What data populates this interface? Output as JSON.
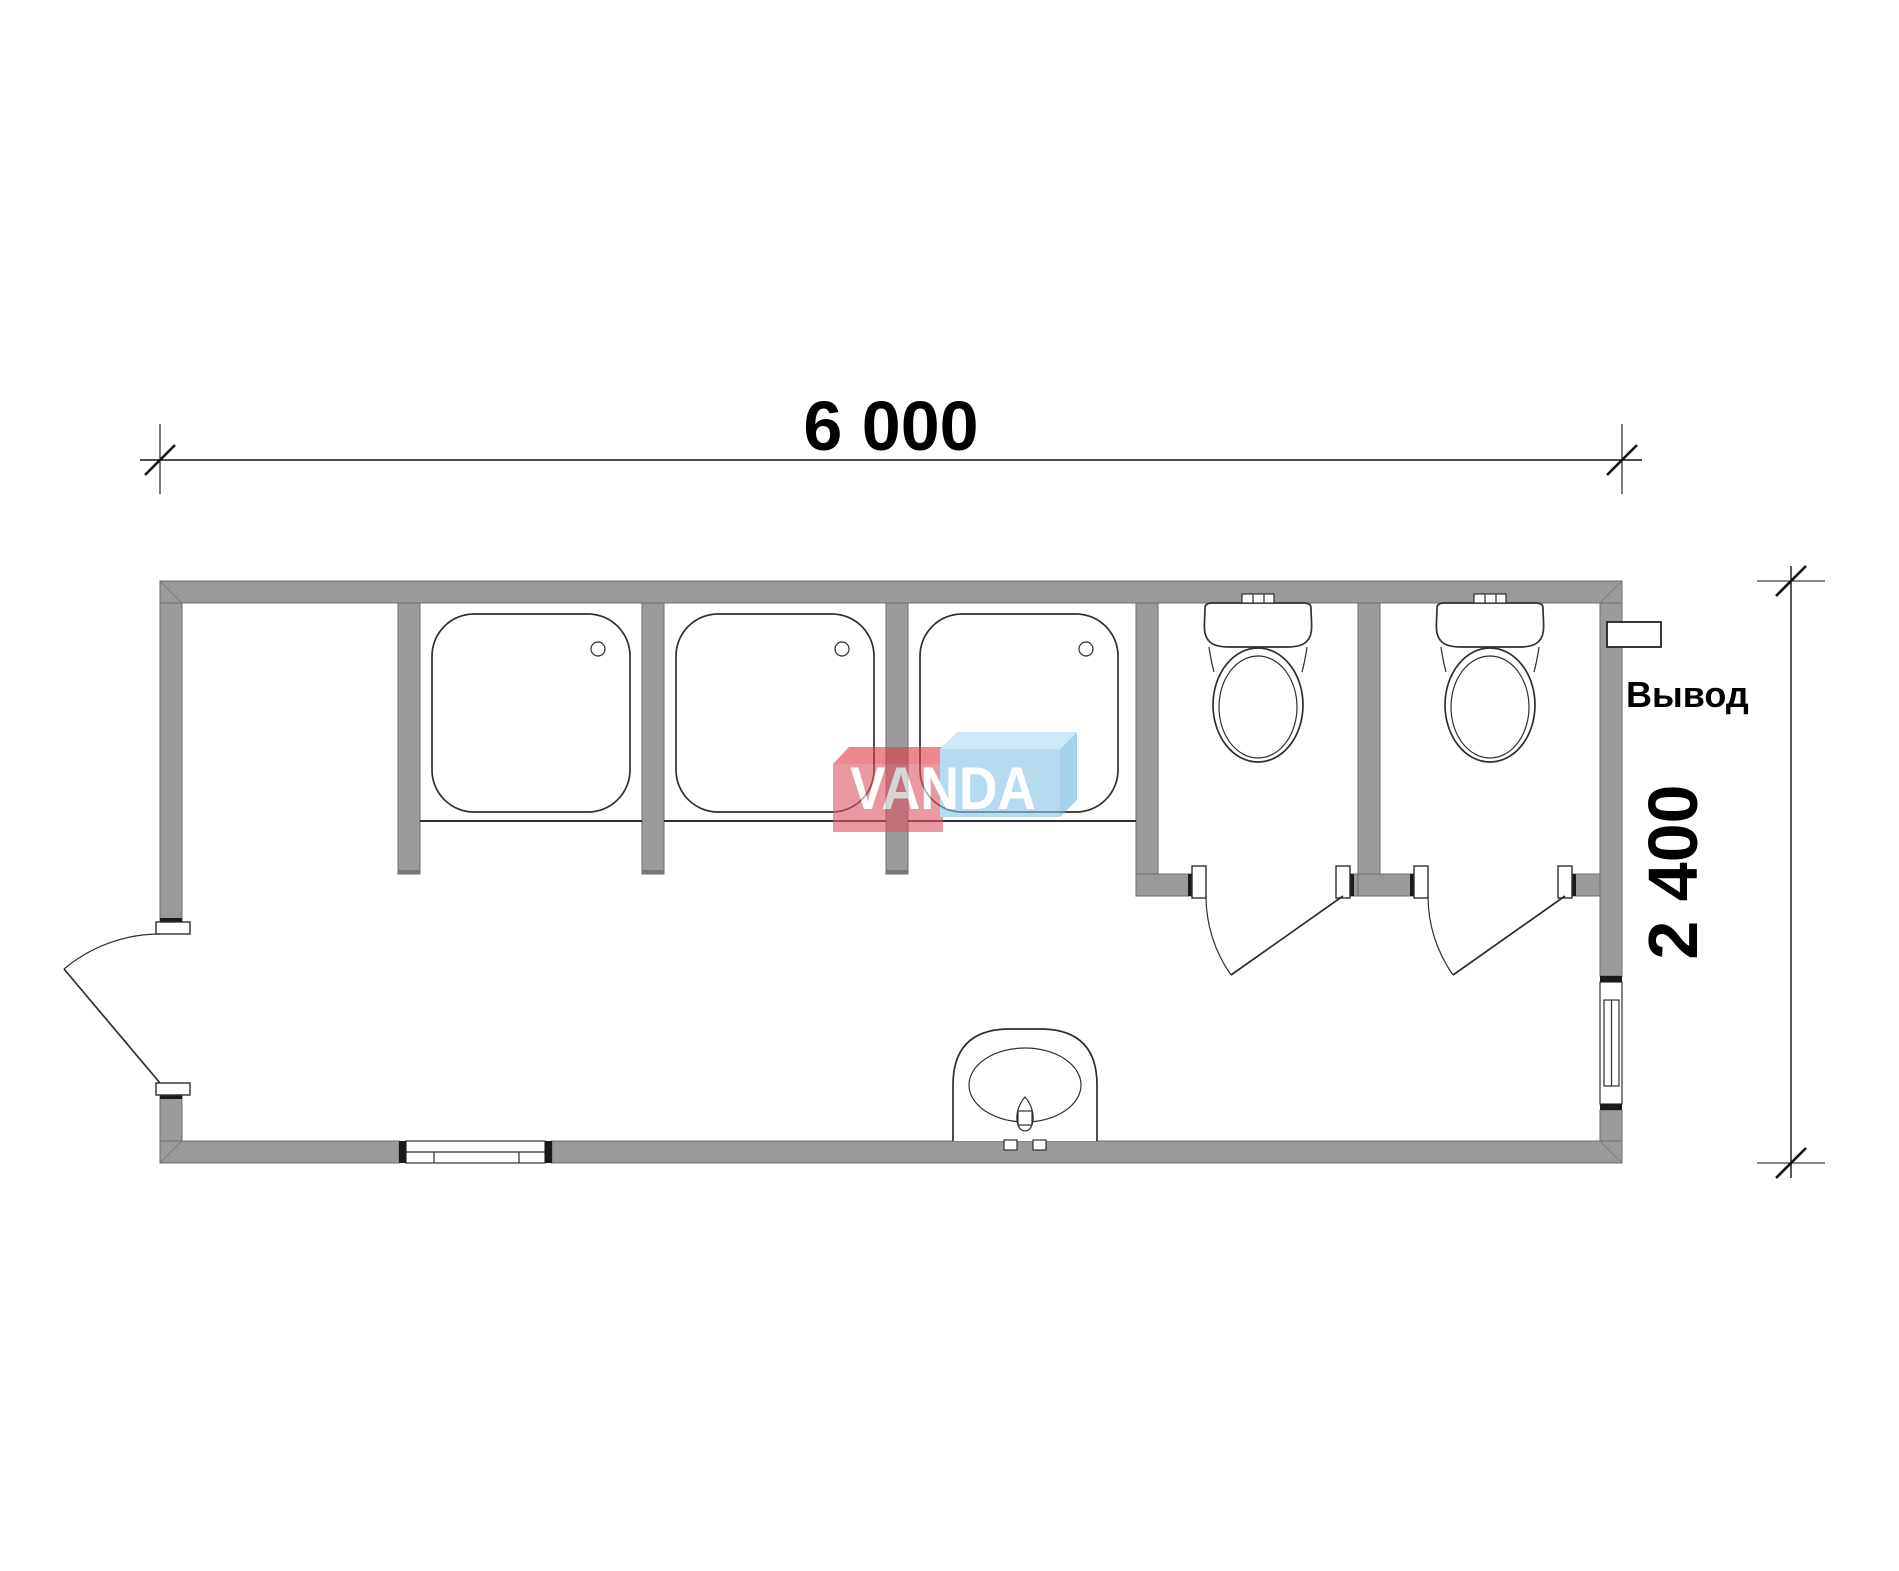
{
  "dimensions": {
    "width_label": "6 000",
    "height_label": "2 400"
  },
  "labels": {
    "outlet": "Вывод"
  },
  "watermark": {
    "text": "VANDA",
    "red_top": "#e33946",
    "red_front": "#dd5767",
    "blue_top": "#afdaf2",
    "blue_side": "#6bb7dc",
    "blue_front": "#84c5e4",
    "text_color": "#ffffff"
  },
  "colors": {
    "wall": "#9a9a9a",
    "wall_edge": "#6e6e6e",
    "line": "#2f2f2f",
    "dimension": "#111111",
    "background": "#ffffff"
  },
  "fixtures": {
    "shower_trays": 3,
    "toilets": 2,
    "washbasins": 1,
    "wc_stalls": 2,
    "doors": 3,
    "windows": 2
  }
}
